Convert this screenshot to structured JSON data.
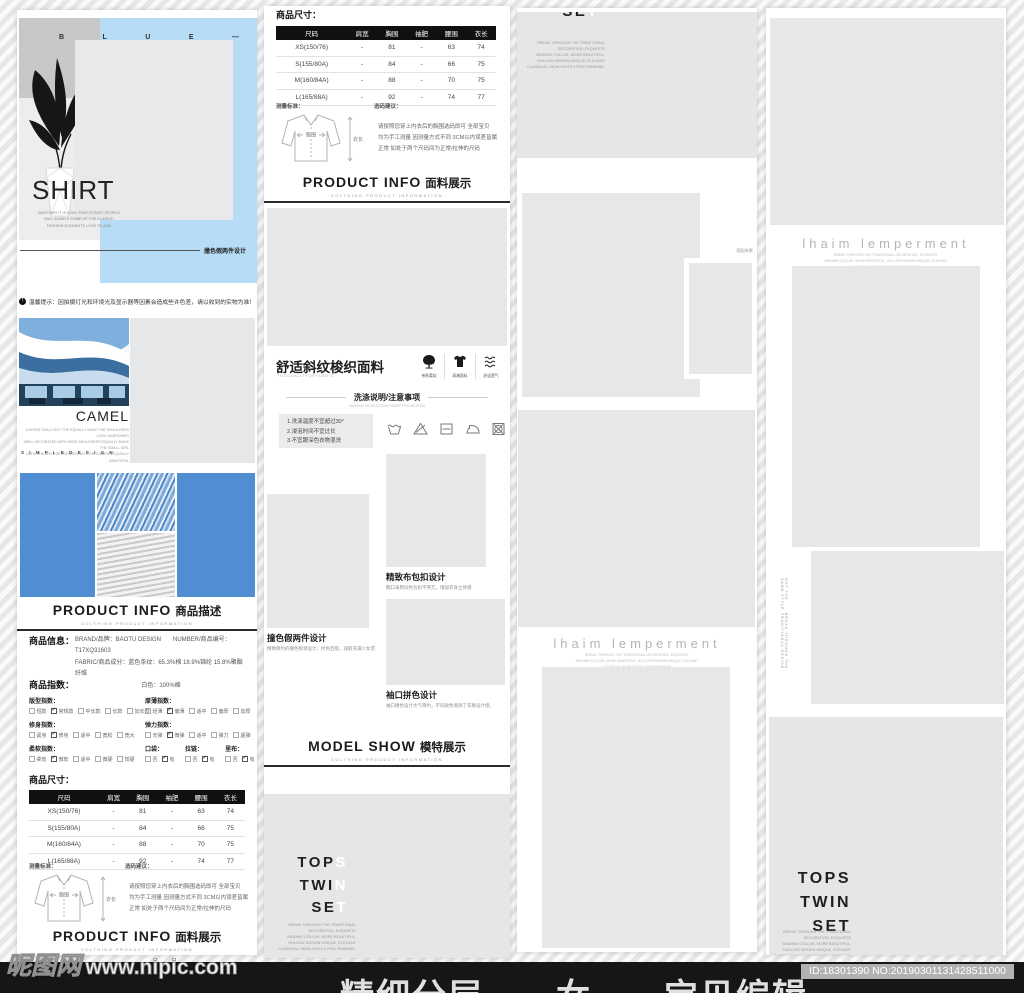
{
  "colors": {
    "accent_blue": "#4f8ed3",
    "hero_blue": "#b7dcf6",
    "placeholder_gray": "#e6e7e9",
    "footer_bg": "#161616"
  },
  "watermark": {
    "brand": "昵图网",
    "site": "www.nipic.com"
  },
  "footer": {
    "big_text": "精细分层——女——宝贝编辑",
    "badge": "ID:18301390 NO:20190301131428511000"
  },
  "hero": {
    "letters": [
      "B",
      "L",
      "U",
      "E",
      "—"
    ],
    "title": "SHIRT",
    "sub_lines": [
      "WHETHER IT IS A BIG STAR STREET PEOPLE",
      "WILL ALWAYS SOME OF THE CLASSIC",
      "FASHION ELEMENTS LOVE TO ADD"
    ],
    "tagline": "撞色假两件设计"
  },
  "notice": {
    "icon_glyph": "!",
    "text": "温馨提示：因拍摄灯光和环境光及显示器等因素会造成些许色差，请以收到的实物为准！"
  },
  "camel": {
    "title": "CAMEL",
    "desc_lines": [
      "A WORD SHALL NOT THE EQUALLY MAKE THE SHOULDERS LOOK NARROWER",
      "WELL DECORATED WITH WIDE SHOULDERS EQUALLY MAKE THE SMALL GIRL",
      "LOOK THE WELL DECORATED WITH SHOULDERS EQUALLY BEAUTIFUL"
    ],
    "spaced": "S I M P L E    D E S I G N"
  },
  "headers": {
    "desc": {
      "en": "PRODUCT INFO",
      "cn": "商品描述",
      "sub": "COLTHING PRODUCT INFORMATION"
    },
    "fabric": {
      "en": "PRODUCT INFO",
      "cn": "面料展示",
      "sub": "COLTHING PRODUCT INFORMATION"
    },
    "model": {
      "en": "MODEL SHOW",
      "cn": "模特展示",
      "sub": "COLTHING PRODUCT INFORMATION"
    }
  },
  "info": {
    "label": "商品信息：",
    "line1": "BRAND/品牌：BAOTU DESIGN　　NUMBER/商品编号：T17XQ31603",
    "line2": "FABRIC/商品成分：蓝色条纹：65.3%棉 18.9%锦纶 15.8%聚酯纤维",
    "line3": "白色：100%棉"
  },
  "index": {
    "label": "商品指数：",
    "groups": [
      {
        "name": "版型指数：",
        "options": [
          {
            "t": "短款",
            "c": 0
          },
          {
            "t": "常规款",
            "c": 1
          },
          {
            "t": "中长款",
            "c": 0
          },
          {
            "t": "长款",
            "c": 0
          },
          {
            "t": "加长款",
            "c": 0
          }
        ]
      },
      {
        "name": "厚薄指数：",
        "options": [
          {
            "t": "轻薄",
            "c": 0
          },
          {
            "t": "偏薄",
            "c": 1
          },
          {
            "t": "适中",
            "c": 0
          },
          {
            "t": "偏厚",
            "c": 0
          },
          {
            "t": "加厚",
            "c": 0
          }
        ]
      },
      {
        "name": "修身指数：",
        "options": [
          {
            "t": "紧身",
            "c": 0
          },
          {
            "t": "修身",
            "c": 1
          },
          {
            "t": "适中",
            "c": 0
          },
          {
            "t": "宽松",
            "c": 0
          },
          {
            "t": "宽大",
            "c": 0
          }
        ]
      },
      {
        "name": "弹力指数：",
        "options": [
          {
            "t": "无弹",
            "c": 0
          },
          {
            "t": "微弹",
            "c": 1
          },
          {
            "t": "适中",
            "c": 0
          },
          {
            "t": "弹力",
            "c": 0
          },
          {
            "t": "超弹",
            "c": 0
          }
        ]
      },
      {
        "name": "柔软指数：",
        "options": [
          {
            "t": "柔软",
            "c": 0
          },
          {
            "t": "微软",
            "c": 1
          },
          {
            "t": "适中",
            "c": 0
          },
          {
            "t": "微硬",
            "c": 0
          },
          {
            "t": "较硬",
            "c": 0
          }
        ]
      },
      {
        "name": "口袋：",
        "options": [
          {
            "t": "否",
            "c": 0
          },
          {
            "t": "有",
            "c": 1
          }
        ]
      },
      {
        "name": "拉链：",
        "options": [
          {
            "t": "否",
            "c": 0
          },
          {
            "t": "有",
            "c": 1
          }
        ]
      },
      {
        "name": "里布：",
        "options": [
          {
            "t": "否",
            "c": 0
          },
          {
            "t": "有",
            "c": 1
          }
        ]
      }
    ]
  },
  "size": {
    "label": "商品尺寸：",
    "headers": [
      "尺码",
      "肩宽",
      "胸围",
      "袖肥",
      "腰围",
      "衣长"
    ],
    "rows": [
      [
        "XS(150/76)",
        "-",
        "81",
        "-",
        "63",
        "74"
      ],
      [
        "S(155/80A)",
        "-",
        "84",
        "-",
        "66",
        "75"
      ],
      [
        "M(160/84A)",
        "-",
        "88",
        "-",
        "70",
        "75"
      ],
      [
        "L(165/88A)",
        "-",
        "92",
        "-",
        "74",
        "77"
      ]
    ],
    "measure_label": "测量标准：",
    "advice_label": "选码建议：",
    "advice_lines": [
      "请按照您穿上内衣后的胸围选码即可 全部宝贝",
      "均为手工测量 因测量方式不同 3CM以内误差皆属",
      "正常 如处于两个尺码间为正常/拉伸的尺码"
    ],
    "diagram": {
      "chest": "胸围",
      "length": "衣长"
    }
  },
  "fabric": {
    "title": "舒适斜纹梭织面料",
    "sub": "T H E   Q U A L I T Y   O F   F A B R I C",
    "features": [
      {
        "label": "亲肤柔软"
      },
      {
        "label": "高端面料"
      },
      {
        "label": "舒适透气"
      }
    ]
  },
  "washing": {
    "title": "洗涤说明/注意事项",
    "sub": "WASHING INSTRUCTIONS FABRIC PRECAUTIONS",
    "rules": [
      "1.洗涤温度不宜超过30°",
      "2.浸泡时间不宜过长",
      "3.不宜跟深色衣物混洗"
    ]
  },
  "details": [
    {
      "title": "撞色假两件设计",
      "desc": "精致简约的撞色假领设计，时尚百搭，减龄充满少女范"
    },
    {
      "title": "精致布包扣设计",
      "desc": "胸口采用同色包扣不突兀，增加衣身立体感"
    },
    {
      "title": "袖口拼色设计",
      "desc": "袖口撞色设计大气简约，不同颜色增添了衣服设计感。"
    }
  ],
  "tops": {
    "lines": [
      {
        "dark": "TOP",
        "light": "S"
      },
      {
        "dark": "TWI",
        "light": "N"
      },
      {
        "dark": "SE",
        "light": "T"
      }
    ],
    "small_lines": [
      "BREAK THROUGH THE TRADITIONAL",
      "DECORATION, EXQUISITE",
      "BINDING COLLAR, MORE BEAUTIFUL,",
      "HOLLOW DESIGN UNIQUE, ELEGANT",
      "CLASSICAL HIGHLIGHTS A FEW FEMININE."
    ]
  },
  "tops_end": {
    "lines": [
      "TOPS",
      "TWIN",
      "SET"
    ]
  },
  "lhaim": {
    "title": "lhaim lemperment",
    "small_lines": [
      "BREAK THROUGH THE TRADITIONAL DECORATION, EXQUISITE",
      "BINDING COLLAR, MORE BEAUTIFUL, HOLLOW DESIGN UNIQUE, ELEGANT",
      "CLASSICAL HIGHLIGHTS A FEW FEMININE."
    ]
  },
  "match_tag": "搭配效果",
  "vertical_text": [
    "NOT THE SAME STYLE",
    "BREAK THROUGH THE TRADITIONAL DESIGN"
  ]
}
